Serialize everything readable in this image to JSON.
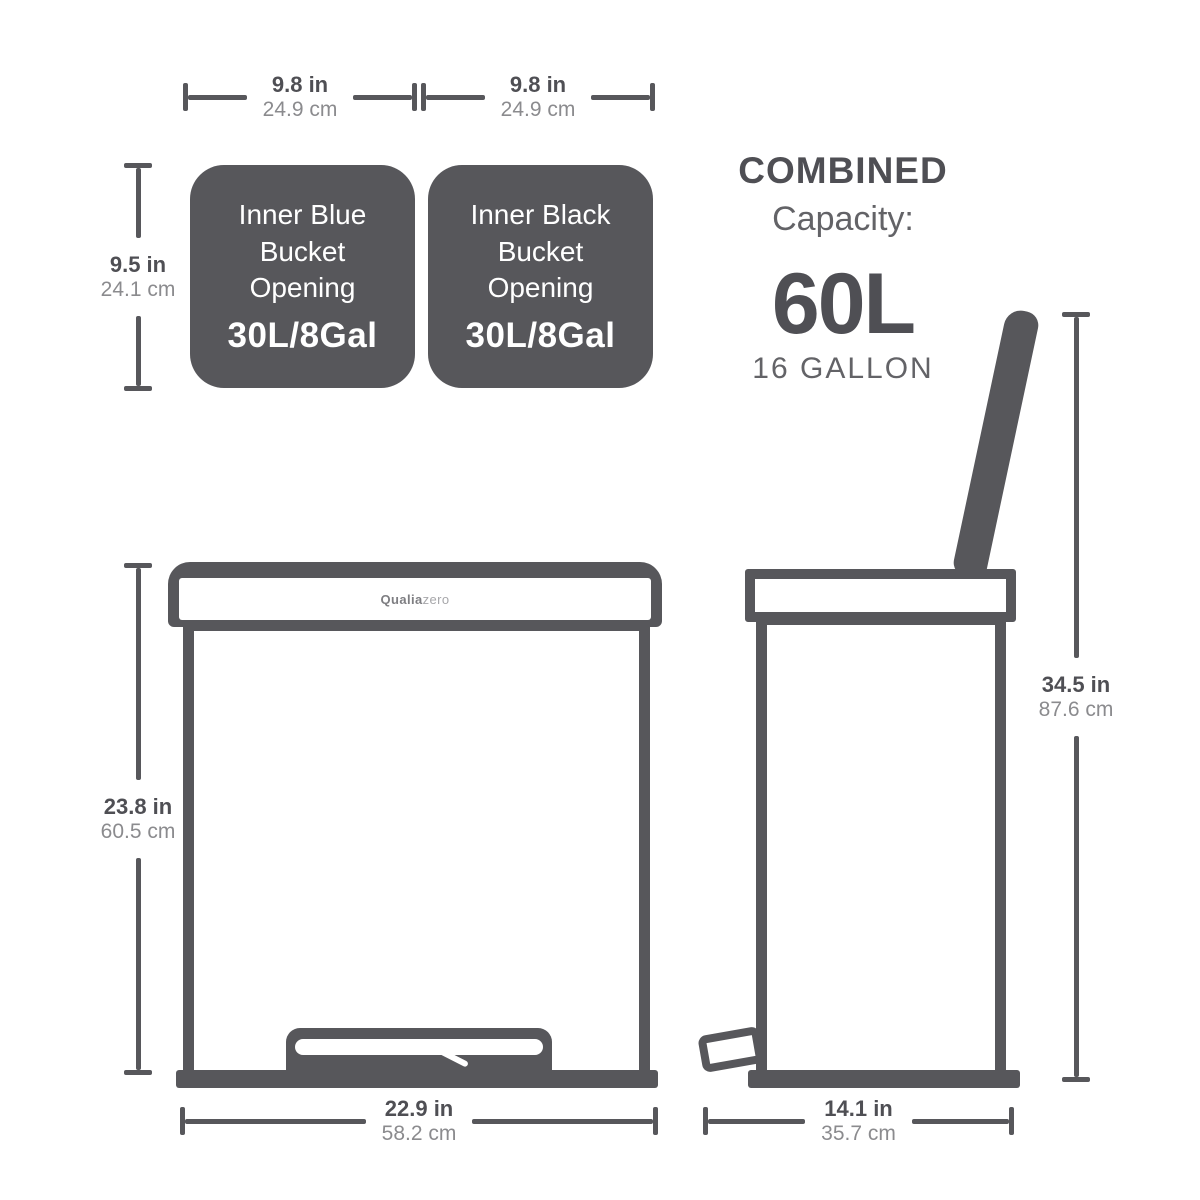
{
  "colors": {
    "shape": "#57575b",
    "ink": "#4f4f54",
    "ink_light": "#8b8b8e",
    "sub": "#636367"
  },
  "openings": {
    "left": {
      "label": "Inner Blue Bucket Opening",
      "volume": "30L/8Gal"
    },
    "right": {
      "label": "Inner Black Bucket Opening",
      "volume": "30L/8Gal"
    }
  },
  "combined": {
    "title": "COMBINED",
    "subtitle": "Capacity:",
    "value": "60L",
    "gallons": "16 GALLON"
  },
  "brand": {
    "bold": "Qualia",
    "light": "zero"
  },
  "dims": {
    "bucket_left_w": {
      "inches": "9.8 in",
      "cm": "24.9 cm"
    },
    "bucket_right_w": {
      "inches": "9.8 in",
      "cm": "24.9 cm"
    },
    "bucket_h": {
      "inches": "9.5 in",
      "cm": "24.1 cm"
    },
    "front_h": {
      "inches": "23.8 in",
      "cm": "60.5 cm"
    },
    "front_w": {
      "inches": "22.9 in",
      "cm": "58.2 cm"
    },
    "side_h": {
      "inches": "34.5 in",
      "cm": "87.6 cm"
    },
    "side_d": {
      "inches": "14.1 in",
      "cm": "35.7 cm"
    }
  }
}
